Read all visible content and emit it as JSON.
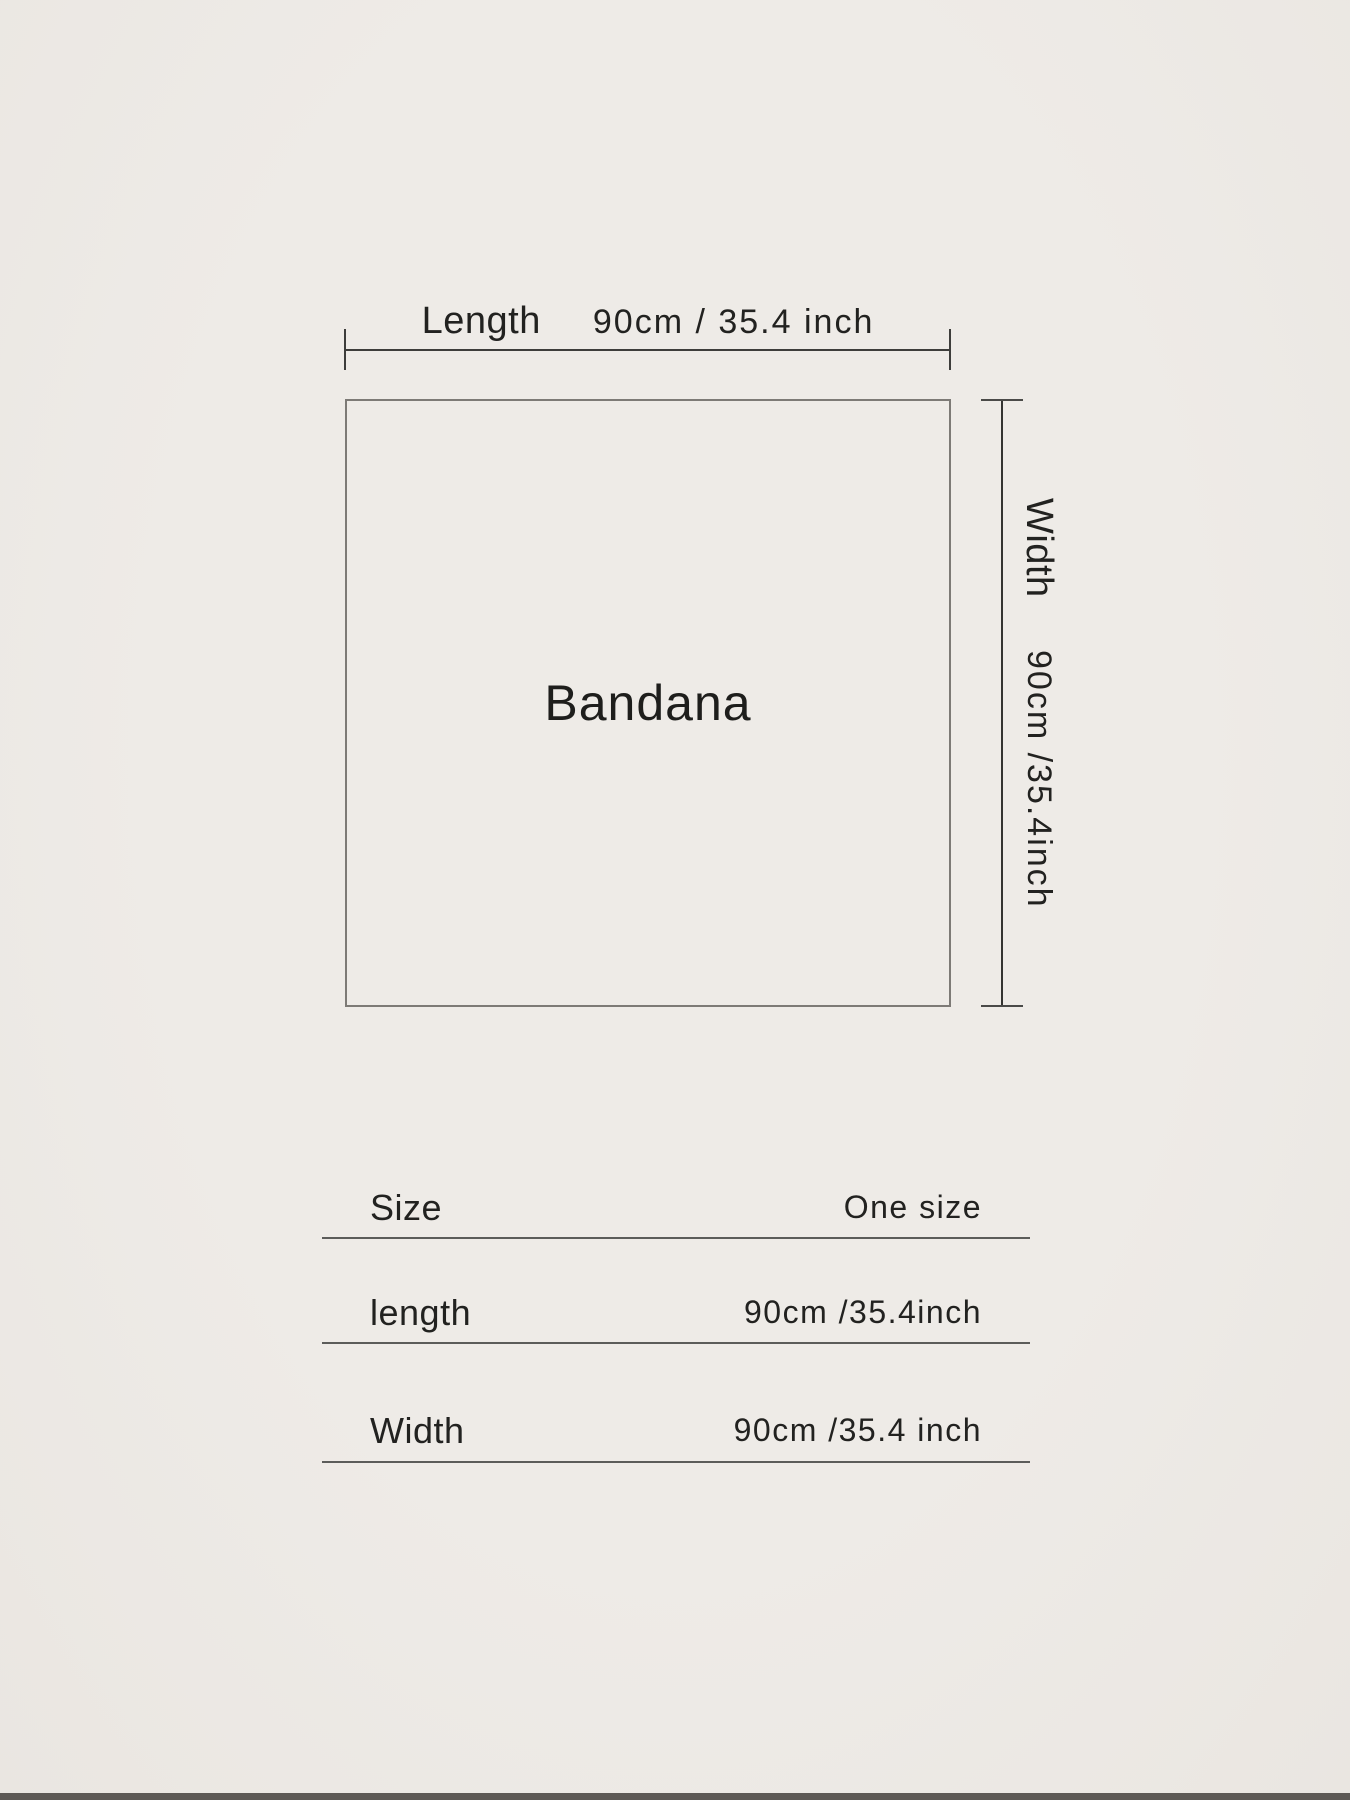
{
  "colors": {
    "background": "#ece9e5",
    "text": "#222220",
    "outline": "#7d7a76",
    "dimension_line": "#3d3d3b",
    "table_rule": "#5c5c5a"
  },
  "diagram": {
    "product_label": "Bandana",
    "top_dimension": {
      "label": "Length",
      "value": "90cm / 35.4 inch"
    },
    "side_dimension": {
      "label": "Width",
      "value": "90cm /35.4inch"
    }
  },
  "size_table": {
    "rows": [
      {
        "label": "Size",
        "value": "One size"
      },
      {
        "label": "length",
        "value": "90cm /35.4inch"
      },
      {
        "label": "Width",
        "value": "90cm /35.4 inch"
      }
    ]
  }
}
